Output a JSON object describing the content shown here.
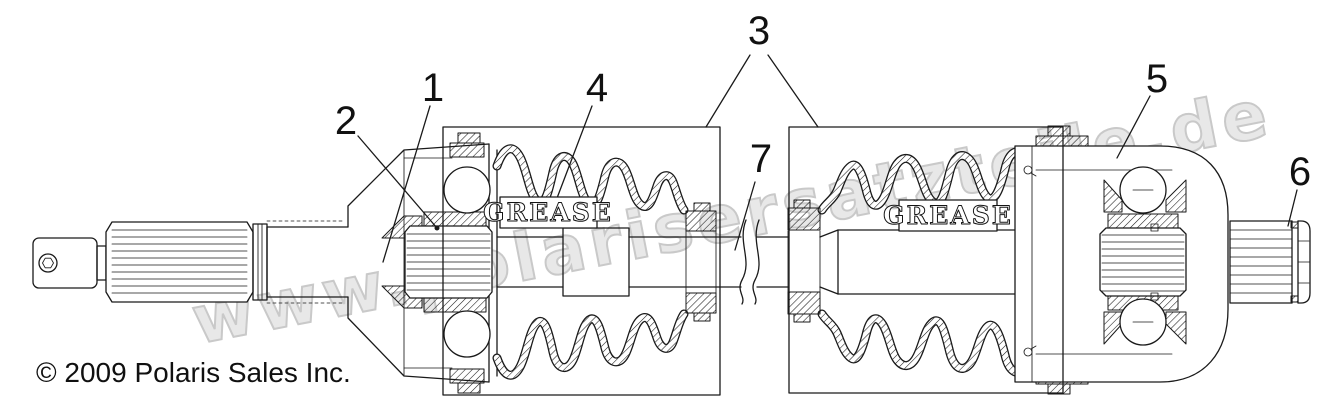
{
  "diagram": {
    "watermark": "www.polarisersatzteile.de",
    "copyright": "© 2009 Polaris Sales Inc.",
    "grease_label": "GREASE",
    "callouts": {
      "c1": "1",
      "c2": "2",
      "c3": "3",
      "c4": "4",
      "c5": "5",
      "c6": "6",
      "c7": "7"
    },
    "colors": {
      "line": "#1a1a1a",
      "watermark_fill": "#e8e8e8",
      "watermark_stroke": "#c9c9c9",
      "background": "#ffffff"
    }
  }
}
